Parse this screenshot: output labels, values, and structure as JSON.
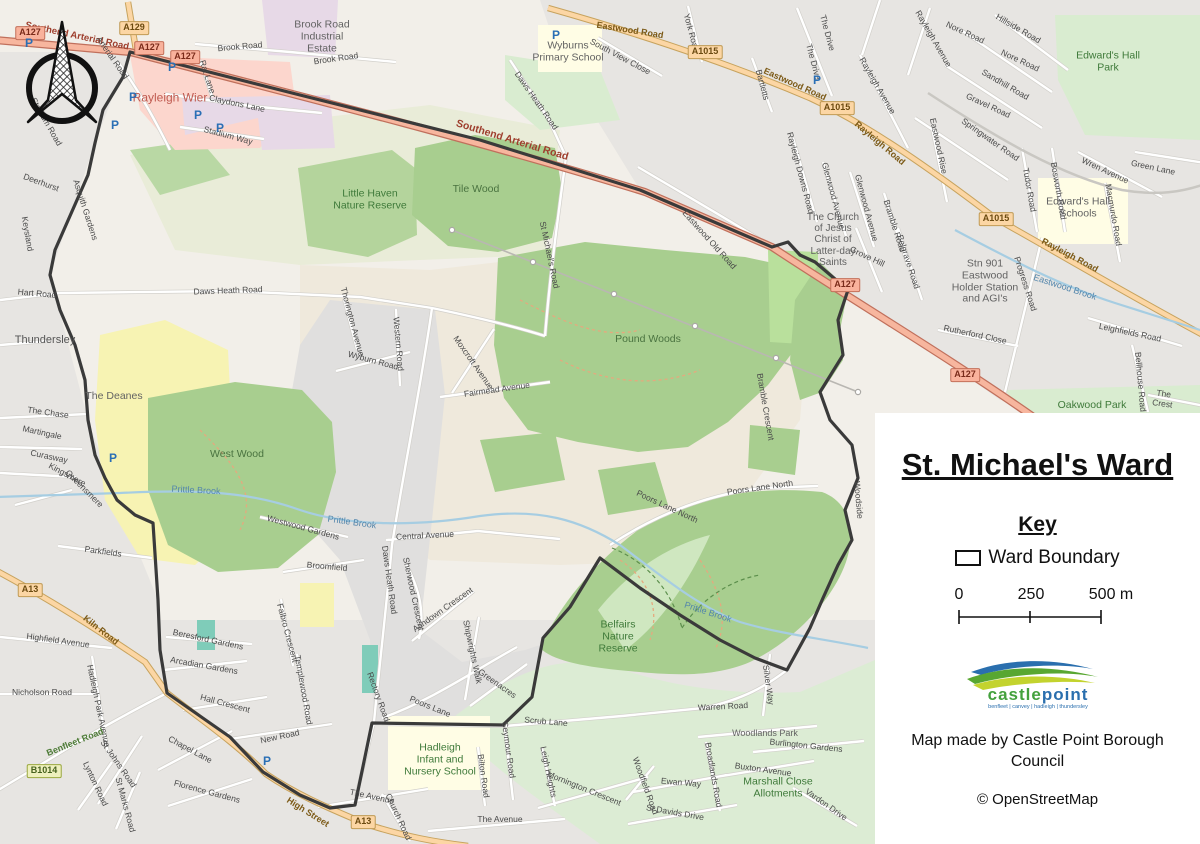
{
  "legend": {
    "title": "St. Michael's Ward",
    "key_heading": "Key",
    "ward_boundary_label": "Ward Boundary",
    "scale": {
      "t0": "0",
      "t1": "250",
      "t2": "500 m"
    },
    "logo": {
      "castle": "castle",
      "point": "point",
      "tagline": "benfleet | canvey | hadleigh | thundersley"
    },
    "credit": "Map made by Castle Point Borough Council",
    "osm_credit": "© OpenStreetMap"
  },
  "colors": {
    "boundary": "#3a3a3a",
    "trunk_road": "#f7b69e",
    "primary_road": "#fcd6a4",
    "wood": "#a8ce8f",
    "park": "#d9ecd0",
    "retail": "#fcd6cd",
    "industrial": "#e7d9e7",
    "school": "#fffde5",
    "water": "#a6cde2",
    "deanes_yellow": "#f7f3b3",
    "logo_green": "#44a13d",
    "logo_blue": "#2a6fae"
  },
  "badges": [
    {
      "t": "A127",
      "x": 30,
      "y": 33,
      "c": "trunk"
    },
    {
      "t": "A129",
      "x": 134,
      "y": 28,
      "c": "primary"
    },
    {
      "t": "A127",
      "x": 149,
      "y": 48,
      "c": "trunk"
    },
    {
      "t": "A127",
      "x": 185,
      "y": 57,
      "c": "trunk"
    },
    {
      "t": "A1015",
      "x": 705,
      "y": 52,
      "c": "primary"
    },
    {
      "t": "A1015",
      "x": 837,
      "y": 108,
      "c": "primary"
    },
    {
      "t": "A1015",
      "x": 996,
      "y": 219,
      "c": "primary"
    },
    {
      "t": "A127",
      "x": 845,
      "y": 285,
      "c": "trunk"
    },
    {
      "t": "A127",
      "x": 965,
      "y": 375,
      "c": "trunk"
    },
    {
      "t": "A13",
      "x": 30,
      "y": 590,
      "c": "primary"
    },
    {
      "t": "B1014",
      "x": 44,
      "y": 771,
      "c": "broad"
    },
    {
      "t": "A13",
      "x": 363,
      "y": 822,
      "c": "primary"
    }
  ],
  "parking": [
    {
      "x": 29,
      "y": 43
    },
    {
      "x": 115,
      "y": 125
    },
    {
      "x": 133,
      "y": 97
    },
    {
      "x": 172,
      "y": 67
    },
    {
      "x": 198,
      "y": 115
    },
    {
      "x": 220,
      "y": 128
    },
    {
      "x": 113,
      "y": 458
    },
    {
      "x": 267,
      "y": 761
    },
    {
      "x": 556,
      "y": 35
    },
    {
      "x": 817,
      "y": 80
    }
  ],
  "labels": [
    {
      "t": "Southend Arterial Road",
      "x": 77,
      "y": 37,
      "r": 12,
      "c": "trunk"
    },
    {
      "t": "Southend Arterial Road",
      "x": 512,
      "y": 141,
      "r": 17,
      "c": "trunk",
      "s": 10.5
    },
    {
      "t": "Arterial Road",
      "x": 112,
      "y": 58,
      "r": 55,
      "c": "street"
    },
    {
      "t": "Stadium Road",
      "x": 46,
      "y": 122,
      "r": 60,
      "c": "street"
    },
    {
      "t": "Rat Lane",
      "x": 207,
      "y": 77,
      "r": 72,
      "c": "street"
    },
    {
      "t": "Claydons Lane",
      "x": 237,
      "y": 104,
      "r": 12,
      "c": "street"
    },
    {
      "t": "Stadium Way",
      "x": 228,
      "y": 136,
      "r": 15,
      "c": "street"
    },
    {
      "t": "Rayleigh Wier",
      "x": 170,
      "y": 98,
      "r": 0,
      "c": "retail"
    },
    {
      "t": "Brook Road",
      "x": 240,
      "y": 47,
      "r": -5,
      "c": "street"
    },
    {
      "t": "Brook Road",
      "x": 336,
      "y": 59,
      "r": -8,
      "c": "street"
    },
    {
      "t": "Brook Road\nIndustrial\nEstate",
      "x": 322,
      "y": 37,
      "r": 0,
      "c": "area"
    },
    {
      "t": "Wyburns\nPrimary School",
      "x": 568,
      "y": 52,
      "r": 0,
      "c": "area"
    },
    {
      "t": "South View Close",
      "x": 620,
      "y": 57,
      "r": 28,
      "c": "street"
    },
    {
      "t": "York Road",
      "x": 691,
      "y": 33,
      "r": 75,
      "c": "street"
    },
    {
      "t": "Eastwood Road",
      "x": 630,
      "y": 30,
      "r": 9,
      "c": "primary"
    },
    {
      "t": "Eastwood Road",
      "x": 795,
      "y": 84,
      "r": 24,
      "c": "primary"
    },
    {
      "t": "The Drive",
      "x": 827,
      "y": 33,
      "r": 75,
      "c": "street"
    },
    {
      "t": "The Drive",
      "x": 813,
      "y": 62,
      "r": 75,
      "c": "street"
    },
    {
      "t": "Bartletts",
      "x": 762,
      "y": 85,
      "r": 75,
      "c": "street"
    },
    {
      "t": "Rayleigh Road",
      "x": 880,
      "y": 143,
      "r": 40,
      "c": "primary"
    },
    {
      "t": "Rayleigh Road",
      "x": 1070,
      "y": 255,
      "r": 28,
      "c": "primary"
    },
    {
      "t": "Rayleigh Avenue",
      "x": 877,
      "y": 86,
      "r": 60,
      "c": "street"
    },
    {
      "t": "Rayleigh Avenue",
      "x": 933,
      "y": 39,
      "r": 60,
      "c": "street"
    },
    {
      "t": "Nore Road",
      "x": 965,
      "y": 33,
      "r": 25,
      "c": "street"
    },
    {
      "t": "Nore Road",
      "x": 1020,
      "y": 61,
      "r": 25,
      "c": "street"
    },
    {
      "t": "Hillside Road",
      "x": 1018,
      "y": 29,
      "r": 30,
      "c": "street"
    },
    {
      "t": "Sandhill Road",
      "x": 1005,
      "y": 85,
      "r": 30,
      "c": "street"
    },
    {
      "t": "Gravel Road",
      "x": 988,
      "y": 106,
      "r": 25,
      "c": "street"
    },
    {
      "t": "Springwater Road",
      "x": 990,
      "y": 140,
      "r": 35,
      "c": "street"
    },
    {
      "t": "Eastwood Rise",
      "x": 938,
      "y": 146,
      "r": 78,
      "c": "street"
    },
    {
      "t": "Tudor Road",
      "x": 1029,
      "y": 190,
      "r": 80,
      "c": "street"
    },
    {
      "t": "Bosworth Road",
      "x": 1058,
      "y": 191,
      "r": 80,
      "c": "street"
    },
    {
      "t": "Wren Avenue",
      "x": 1105,
      "y": 171,
      "r": 25,
      "c": "street"
    },
    {
      "t": "Green Lane",
      "x": 1153,
      "y": 168,
      "r": 12,
      "c": "street"
    },
    {
      "t": "Macmurdo Road",
      "x": 1113,
      "y": 215,
      "r": 80,
      "c": "street"
    },
    {
      "t": "Edward's Hall\nPark",
      "x": 1108,
      "y": 62,
      "r": 0,
      "c": "green"
    },
    {
      "t": "Edward's Hall\nSchools",
      "x": 1078,
      "y": 208,
      "r": 0,
      "c": "area"
    },
    {
      "t": "Rayleigh Downs Road",
      "x": 800,
      "y": 173,
      "r": 75,
      "c": "street"
    },
    {
      "t": "Glenwood Avenue",
      "x": 833,
      "y": 196,
      "r": 75,
      "c": "street"
    },
    {
      "t": "Glenwood Avenue",
      "x": 866,
      "y": 208,
      "r": 75,
      "c": "street"
    },
    {
      "t": "Grove Hill",
      "x": 867,
      "y": 257,
      "r": 25,
      "c": "street"
    },
    {
      "t": "Bramble Road",
      "x": 894,
      "y": 226,
      "r": 72,
      "c": "street"
    },
    {
      "t": "Belgrave Road",
      "x": 908,
      "y": 262,
      "r": 72,
      "c": "street"
    },
    {
      "t": "The Church\nof Jesus\nChrist of\nLatter-day\nSaints",
      "x": 833,
      "y": 240,
      "r": 0,
      "c": "area",
      "s": 10
    },
    {
      "t": "Stn 901\nEastwood\nHolder Station\nand AGI's",
      "x": 985,
      "y": 282,
      "r": 0,
      "c": "area"
    },
    {
      "t": "Eastwood Brook",
      "x": 1065,
      "y": 287,
      "r": 18,
      "c": "water"
    },
    {
      "t": "Progress Road",
      "x": 1025,
      "y": 284,
      "r": 72,
      "c": "street"
    },
    {
      "t": "Rutherford Close",
      "x": 975,
      "y": 335,
      "r": 12,
      "c": "street"
    },
    {
      "t": "Leighfields Road",
      "x": 1130,
      "y": 333,
      "r": 12,
      "c": "street"
    },
    {
      "t": "Bellhouse Road",
      "x": 1140,
      "y": 382,
      "r": 85,
      "c": "street"
    },
    {
      "t": "The Crest",
      "x": 1163,
      "y": 399,
      "r": 8,
      "c": "street"
    },
    {
      "t": "Oakwood Park",
      "x": 1092,
      "y": 406,
      "r": 0,
      "c": "green"
    },
    {
      "t": "Eastwood Old Road",
      "x": 709,
      "y": 240,
      "r": 48,
      "c": "street"
    },
    {
      "t": "Daws Heath Road",
      "x": 536,
      "y": 101,
      "r": 55,
      "c": "street"
    },
    {
      "t": "St Michael's Road",
      "x": 549,
      "y": 255,
      "r": 78,
      "c": "street"
    },
    {
      "t": "Little Haven\nNature Reserve",
      "x": 370,
      "y": 200,
      "r": 0,
      "c": "green"
    },
    {
      "t": "Tile Wood",
      "x": 476,
      "y": 190,
      "r": 0,
      "c": "wood"
    },
    {
      "t": "Pound Woods",
      "x": 648,
      "y": 340,
      "r": 0,
      "c": "wood"
    },
    {
      "t": "West Wood",
      "x": 237,
      "y": 455,
      "r": 0,
      "c": "wood"
    },
    {
      "t": "The Deanes",
      "x": 114,
      "y": 397,
      "r": 0,
      "c": "area"
    },
    {
      "t": "Thundersley",
      "x": 45,
      "y": 340,
      "r": 0,
      "c": "place"
    },
    {
      "t": "Hart Road",
      "x": 37,
      "y": 294,
      "r": 5,
      "c": "street"
    },
    {
      "t": "Daws Heath Road",
      "x": 228,
      "y": 291,
      "r": -2,
      "c": "street"
    },
    {
      "t": "Deerhurst",
      "x": 41,
      "y": 183,
      "r": 20,
      "c": "street"
    },
    {
      "t": "Asquith Gardens",
      "x": 85,
      "y": 210,
      "r": 72,
      "c": "street"
    },
    {
      "t": "Keysland",
      "x": 27,
      "y": 234,
      "r": 80,
      "c": "street"
    },
    {
      "t": "The Chase",
      "x": 48,
      "y": 413,
      "r": 8,
      "c": "street"
    },
    {
      "t": "Martingale",
      "x": 42,
      "y": 433,
      "r": 12,
      "c": "street"
    },
    {
      "t": "Curasway",
      "x": 49,
      "y": 457,
      "r": 12,
      "c": "street"
    },
    {
      "t": "Kingsmere",
      "x": 67,
      "y": 475,
      "r": 28,
      "c": "street"
    },
    {
      "t": "Queensmere",
      "x": 84,
      "y": 489,
      "r": 45,
      "c": "street"
    },
    {
      "t": "Parkfields",
      "x": 103,
      "y": 552,
      "r": 8,
      "c": "street"
    },
    {
      "t": "Kiln Road",
      "x": 101,
      "y": 630,
      "r": 38,
      "c": "primary"
    },
    {
      "t": "Highfield Avenue",
      "x": 58,
      "y": 641,
      "r": 8,
      "c": "street"
    },
    {
      "t": "Nicholson Road",
      "x": 42,
      "y": 693,
      "r": 0,
      "c": "street"
    },
    {
      "t": "Hadleigh Park Avenue",
      "x": 98,
      "y": 706,
      "r": 78,
      "c": "street"
    },
    {
      "t": "Benfleet Road",
      "x": 75,
      "y": 742,
      "r": -22,
      "c": "broad"
    },
    {
      "t": "St Johns Road",
      "x": 118,
      "y": 764,
      "r": 55,
      "c": "street"
    },
    {
      "t": "Lynton Road",
      "x": 95,
      "y": 784,
      "r": 65,
      "c": "street"
    },
    {
      "t": "St Marks Road",
      "x": 125,
      "y": 805,
      "r": 75,
      "c": "street"
    },
    {
      "t": "Chapel Lane",
      "x": 190,
      "y": 750,
      "r": 28,
      "c": "street"
    },
    {
      "t": "Florence Gardens",
      "x": 207,
      "y": 792,
      "r": 15,
      "c": "street"
    },
    {
      "t": "New Road",
      "x": 280,
      "y": 737,
      "r": -12,
      "c": "street"
    },
    {
      "t": "High Street",
      "x": 308,
      "y": 812,
      "r": 32,
      "c": "primary"
    },
    {
      "t": "Church Road",
      "x": 398,
      "y": 817,
      "r": 65,
      "c": "street"
    },
    {
      "t": "The Avenue",
      "x": 372,
      "y": 797,
      "r": 12,
      "c": "street"
    },
    {
      "t": "The Avenue",
      "x": 500,
      "y": 820,
      "r": 0,
      "c": "street"
    },
    {
      "t": "Hadleigh\nInfant and\nNursery School",
      "x": 440,
      "y": 760,
      "r": 0,
      "c": "green"
    },
    {
      "t": "Bilton Road",
      "x": 483,
      "y": 776,
      "r": 82,
      "c": "street"
    },
    {
      "t": "Seymour Road",
      "x": 508,
      "y": 750,
      "r": 82,
      "c": "street"
    },
    {
      "t": "Leigh Heights",
      "x": 548,
      "y": 772,
      "r": 78,
      "c": "street"
    },
    {
      "t": "Mornington Crescent",
      "x": 584,
      "y": 789,
      "r": 22,
      "c": "street"
    },
    {
      "t": "Burlington Gardens",
      "x": 806,
      "y": 746,
      "r": 6,
      "c": "street"
    },
    {
      "t": "Scrub Lane",
      "x": 546,
      "y": 722,
      "r": 5,
      "c": "street"
    },
    {
      "t": "Greenacres",
      "x": 497,
      "y": 684,
      "r": 35,
      "c": "street"
    },
    {
      "t": "Shipwrights Walk",
      "x": 472,
      "y": 652,
      "r": 78,
      "c": "street"
    },
    {
      "t": "Poors Lane",
      "x": 430,
      "y": 707,
      "r": 22,
      "c": "street"
    },
    {
      "t": "Ashdown Crescent",
      "x": 443,
      "y": 610,
      "r": -35,
      "c": "street"
    },
    {
      "t": "Sherwood Crescent",
      "x": 413,
      "y": 594,
      "r": 78,
      "c": "street"
    },
    {
      "t": "Daws Heath Road",
      "x": 389,
      "y": 580,
      "r": 82,
      "c": "street"
    },
    {
      "t": "Central Avenue",
      "x": 425,
      "y": 536,
      "r": -3,
      "c": "street"
    },
    {
      "t": "Broomfield",
      "x": 327,
      "y": 567,
      "r": 5,
      "c": "street"
    },
    {
      "t": "Westwood Gardens",
      "x": 303,
      "y": 528,
      "r": 15,
      "c": "street"
    },
    {
      "t": "Falbro Crescent",
      "x": 287,
      "y": 633,
      "r": 75,
      "c": "street"
    },
    {
      "t": "Templewood Road",
      "x": 303,
      "y": 690,
      "r": 80,
      "c": "street"
    },
    {
      "t": "Rectory Road",
      "x": 378,
      "y": 697,
      "r": 70,
      "c": "street"
    },
    {
      "t": "Hall Crescent",
      "x": 225,
      "y": 704,
      "r": 15,
      "c": "street"
    },
    {
      "t": "Arcadian Gardens",
      "x": 204,
      "y": 666,
      "r": 10,
      "c": "street"
    },
    {
      "t": "Beresford Gardens",
      "x": 208,
      "y": 640,
      "r": 12,
      "c": "street"
    },
    {
      "t": "Wyburn Road",
      "x": 373,
      "y": 361,
      "r": 15,
      "c": "street"
    },
    {
      "t": "Western Road",
      "x": 398,
      "y": 344,
      "r": 85,
      "c": "street"
    },
    {
      "t": "Thorington Avenue",
      "x": 352,
      "y": 322,
      "r": 75,
      "c": "street"
    },
    {
      "t": "Moxcroft Avenue",
      "x": 473,
      "y": 363,
      "r": 55,
      "c": "street"
    },
    {
      "t": "Fairmead Avenue",
      "x": 497,
      "y": 390,
      "r": -8,
      "c": "street"
    },
    {
      "t": "Prittle Brook",
      "x": 196,
      "y": 490,
      "r": 3,
      "c": "water"
    },
    {
      "t": "Prittle Brook",
      "x": 352,
      "y": 522,
      "r": 8,
      "c": "water"
    },
    {
      "t": "Prittle Brook",
      "x": 708,
      "y": 612,
      "r": 18,
      "c": "water"
    },
    {
      "t": "Bramble Crescent",
      "x": 765,
      "y": 407,
      "r": 80,
      "c": "street"
    },
    {
      "t": "Poors Lane North",
      "x": 667,
      "y": 507,
      "r": 25,
      "c": "street"
    },
    {
      "t": "Poors Lane North",
      "x": 760,
      "y": 488,
      "r": -8,
      "c": "street"
    },
    {
      "t": "Woodside",
      "x": 858,
      "y": 500,
      "r": 85,
      "c": "street"
    },
    {
      "t": "Belfairs\nNature\nReserve",
      "x": 618,
      "y": 637,
      "r": 0,
      "c": "green"
    },
    {
      "t": "Silver Way",
      "x": 768,
      "y": 685,
      "r": 82,
      "c": "street"
    },
    {
      "t": "Warren Road",
      "x": 723,
      "y": 707,
      "r": -3,
      "c": "street"
    },
    {
      "t": "Woodlands Park",
      "x": 765,
      "y": 733,
      "r": 0,
      "c": "area",
      "s": 9
    },
    {
      "t": "Buxton Avenue",
      "x": 763,
      "y": 770,
      "r": 8,
      "c": "street"
    },
    {
      "t": "Marshall Close\nAllotments",
      "x": 778,
      "y": 788,
      "r": 0,
      "c": "green"
    },
    {
      "t": "Broadlands Road",
      "x": 713,
      "y": 775,
      "r": 80,
      "c": "street"
    },
    {
      "t": "Woodfield Road",
      "x": 645,
      "y": 786,
      "r": 70,
      "c": "street"
    },
    {
      "t": "Ewan Way",
      "x": 681,
      "y": 783,
      "r": 5,
      "c": "street"
    },
    {
      "t": "St Davids Drive",
      "x": 675,
      "y": 813,
      "r": 10,
      "c": "street"
    },
    {
      "t": "Vardon Drive",
      "x": 826,
      "y": 805,
      "r": 35,
      "c": "street"
    }
  ]
}
